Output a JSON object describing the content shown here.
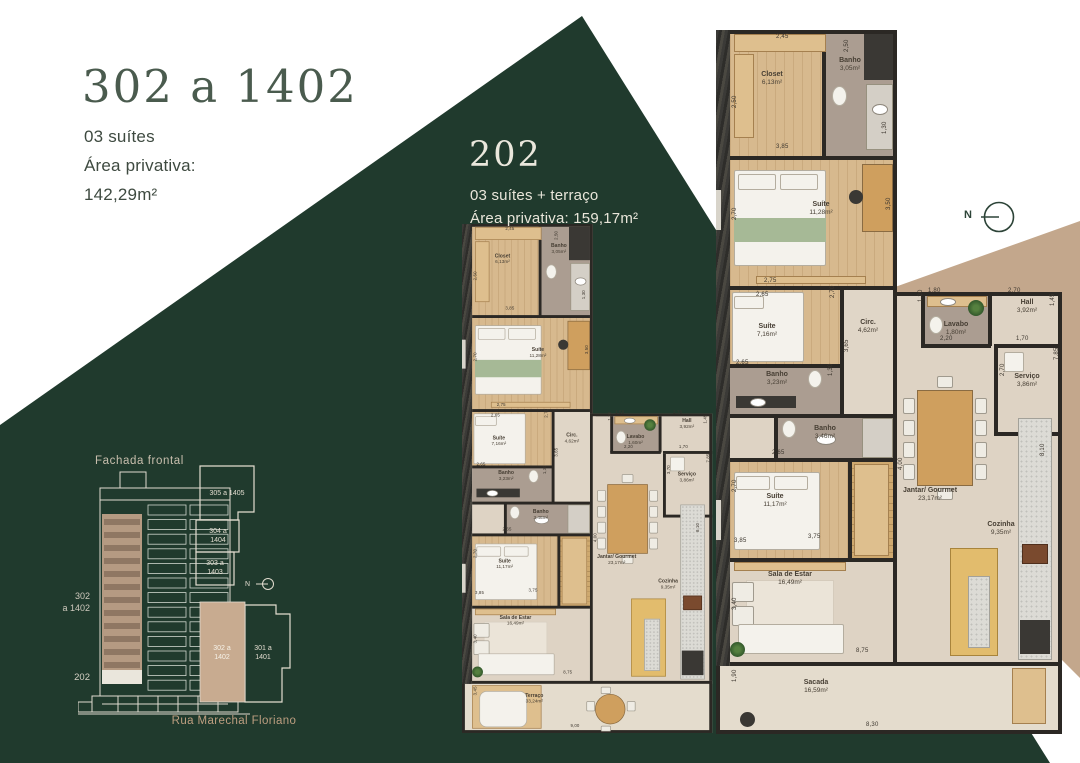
{
  "colors": {
    "green": "#203a2d",
    "beige_wedge": "#c3a78c",
    "keyplan_highlight": "#c8ab90",
    "title_green": "#4a5b4e",
    "cream_text": "#eae7dc",
    "street_tan": "#bd9e80",
    "wall_dark": "#2b2824",
    "floor_base": "#ded3c4",
    "wood_floor": "#d7b98e"
  },
  "unit_302": {
    "title": "302 a 1402",
    "line1": "03 suítes",
    "line2": "Área privativa:",
    "line3": "142,29m²"
  },
  "unit_202": {
    "title": "202",
    "line1": "03 suítes + terraço",
    "line2": "Área privativa: 159,17m²"
  },
  "compass": {
    "label": "N"
  },
  "facade": {
    "label": "Fachada frontal",
    "left_label_lines": [
      "302",
      "a 1402"
    ],
    "floor_202_label": "202"
  },
  "keyplan": {
    "units": [
      "305 a 1405",
      "304 a 1404",
      "303 a 1403",
      "302 a 1402",
      "301 a 1401"
    ],
    "highlighted": "302 a 1402",
    "unit_lines": {
      "u305": [
        "305 a 1405"
      ],
      "u304": [
        "304 a",
        "1404"
      ],
      "u303": [
        "303 a",
        "1403"
      ],
      "u302": [
        "302 a",
        "1402"
      ],
      "u301": [
        "301 a",
        "1401"
      ]
    },
    "compass_label": "N"
  },
  "street": {
    "name": "Rua Marechal Floriano"
  },
  "plan_right": {
    "rooms": [
      {
        "name": "Closet",
        "area": "6,13m²"
      },
      {
        "name": "Banho",
        "area": "3,05m²"
      },
      {
        "name": "Suíte",
        "area": "11,28m²"
      },
      {
        "name": "Suíte",
        "area": "7,16m²"
      },
      {
        "name": "Circ.",
        "area": "4,62m²"
      },
      {
        "name": "Lavabo",
        "area": "1,80m²"
      },
      {
        "name": "Banho",
        "area": "3,23m²"
      },
      {
        "name": "Banho",
        "area": "3,46m²"
      },
      {
        "name": "Suíte",
        "area": "11,17m²"
      },
      {
        "name": "Hall",
        "area": "3,92m²"
      },
      {
        "name": "Serviço",
        "area": "3,86m²"
      },
      {
        "name": "Jantar/ Gourmet",
        "area": "23,17m²"
      },
      {
        "name": "Cozinha",
        "area": "9,35m²"
      },
      {
        "name": "Sala de Estar",
        "area": "16,49m²"
      },
      {
        "name": "Sacada",
        "area": "16,59m²"
      }
    ],
    "dims": [
      "2,45",
      "2,50",
      "2,50",
      "3,85",
      "1,30",
      "2,70",
      "3,50",
      "2,75",
      "2,65",
      "2,70",
      "2,65",
      "3,65",
      "1,30",
      "2,65",
      "2,70",
      "3,75",
      "3,85",
      "3,40",
      "4,00",
      "1,80",
      "1,20",
      "2,20",
      "2,70",
      "1,45",
      "1,70",
      "7,85",
      "2,70",
      "8,10",
      "8,75",
      "8,30",
      "1,90"
    ]
  },
  "plan_left": {
    "rooms": [
      {
        "name": "Closet",
        "area": "6,13m²"
      },
      {
        "name": "Banho",
        "area": "3,05m²"
      },
      {
        "name": "Suíte",
        "area": "11,28m²"
      },
      {
        "name": "Suíte",
        "area": "7,16m²"
      },
      {
        "name": "Circ.",
        "area": "4,62m²"
      },
      {
        "name": "Lavabo",
        "area": "1,60m²"
      },
      {
        "name": "Banho",
        "area": "3,23m²"
      },
      {
        "name": "Banho",
        "area": "3,46m²"
      },
      {
        "name": "Suíte",
        "area": "11,17m²"
      },
      {
        "name": "Hall",
        "area": "3,92m²"
      },
      {
        "name": "Serviço",
        "area": "3,86m²"
      },
      {
        "name": "Jantar/ Gourmet",
        "area": "23,17m²"
      },
      {
        "name": "Cozinha",
        "area": "9,35m²"
      },
      {
        "name": "Sala de Estar",
        "area": "16,49m²"
      },
      {
        "name": "Terraço",
        "area": "33,24m²"
      }
    ],
    "dims": [
      "2,45",
      "2,50",
      "2,50",
      "3,85",
      "1,30",
      "2,70",
      "3,50",
      "2,75",
      "2,65",
      "2,70",
      "2,65",
      "3,65",
      "1,30",
      "2,65",
      "2,70",
      "3,75",
      "3,85",
      "3,40",
      "4,00",
      "1,50",
      "1,20",
      "2,20",
      "2,70",
      "1,45",
      "1,70",
      "7,85",
      "3,70",
      "8,10",
      "8,75",
      "9,00",
      "3,45"
    ]
  }
}
